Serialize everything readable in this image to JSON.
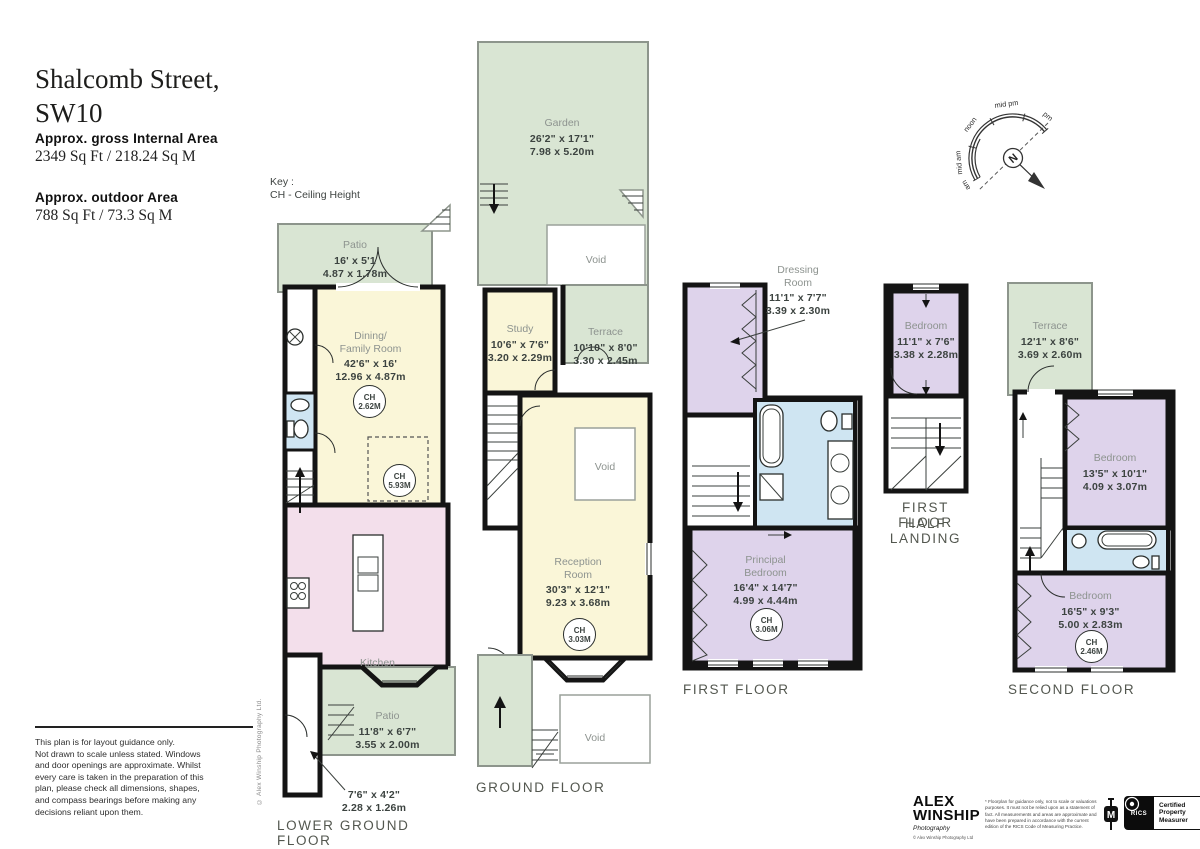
{
  "header": {
    "title": "Shalcomb Street,\nSW10",
    "internal_label": "Approx. gross Internal Area",
    "internal_value": "2349 Sq Ft  /  218.24 Sq M",
    "outdoor_label": "Approx. outdoor Area",
    "outdoor_value": "788 Sq Ft  /  73.3 Sq M"
  },
  "key": {
    "line1": "Key :",
    "line2": "CH - Ceiling Height"
  },
  "compass": {
    "labels": [
      "am",
      "mid am",
      "noon",
      "mid pm",
      "pm"
    ],
    "north": "N"
  },
  "floors": {
    "lgf": {
      "label": "LOWER GROUND FLOOR"
    },
    "gf": {
      "label": "GROUND FLOOR"
    },
    "ff": {
      "label": "FIRST FLOOR"
    },
    "hl": {
      "label_line1": "FIRST FLOOR",
      "label_line2": "HALF LANDING"
    },
    "sf": {
      "label": "SECOND FLOOR"
    }
  },
  "rooms": {
    "void": "Void",
    "lgf_patio_top": {
      "name": "Patio",
      "ft": "16' x 5'1",
      "m": "4.87 x 1.78m"
    },
    "lgf_dining": {
      "name": "Dining/\nFamily Room",
      "ft": "42'6\" x 16'",
      "m": "12.96 x 4.87m",
      "ch1_label": "CH",
      "ch1_value": "2.62M",
      "ch2_label": "CH",
      "ch2_value": "5.93M"
    },
    "lgf_kitchen": {
      "name": "Kitchen"
    },
    "lgf_patio_bottom": {
      "name": "Patio",
      "ft": "11'8\" x 6'7\"",
      "m": "3.55 x 2.00m"
    },
    "lgf_store_callout": {
      "ft": "7'6\" x 4'2\"",
      "m": "2.28 x 1.26m"
    },
    "gf_garden": {
      "name": "Garden",
      "ft": "26'2\" x 17'1\"",
      "m": "7.98 x 5.20m"
    },
    "gf_study": {
      "name": "Study",
      "ft": "10'6\" x 7'6\"",
      "m": "3.20 x 2.29m"
    },
    "gf_terrace": {
      "name": "Terrace",
      "ft": "10'10\" x 8'0\"",
      "m": "3.30 x 2.45m"
    },
    "gf_reception": {
      "name": "Reception\nRoom",
      "ft": "30'3\" x 12'1\"",
      "m": "9.23 x 3.68m",
      "ch_label": "CH",
      "ch_value": "3.03M"
    },
    "ff_dressing": {
      "name": "Dressing\nRoom",
      "ft": "11'1\" x 7'7\"",
      "m": "3.39 x 2.30m"
    },
    "ff_principal": {
      "name": "Principal\nBedroom",
      "ft": "16'4\" x 14'7\"",
      "m": "4.99 x 4.44m",
      "ch_label": "CH",
      "ch_value": "3.06M"
    },
    "hl_bedroom": {
      "name": "Bedroom",
      "ft": "11'1\" x 7'6\"",
      "m": "3.38 x 2.28m"
    },
    "sf_terrace": {
      "name": "Terrace",
      "ft": "12'1\" x 8'6\"",
      "m": "3.69 x 2.60m"
    },
    "sf_bedroom_top": {
      "name": "Bedroom",
      "ft": "13'5\" x 10'1\"",
      "m": "4.09 x 3.07m"
    },
    "sf_bedroom_bottom": {
      "name": "Bedroom",
      "ft": "16'5\" x 9'3\"",
      "m": "5.00 x 2.83m",
      "ch_label": "CH",
      "ch_value": "2.46M"
    }
  },
  "footer": {
    "disclaimer": "This plan is for layout guidance only.\nNot drawn to scale unless stated. Windows\nand door openings are approximate. Whilst\nevery care is taken in the preparation of this\nplan, please check all dimensions, shapes,\nand compass bearings before making any\ndecisions reliant upon them.",
    "copyright_vertical": "© Alex Winship Photography Ltd.",
    "logo_line1": "ALEX",
    "logo_line2": "WINSHIP",
    "logo_sub": "Photography",
    "logo_tiny": "© Alex Winship Photography Ltd",
    "fine_print": "* Floorplan for guidance only, not to scale or valuations purposes. It must not be relied upon as a statement of fact. All measurements and areas are approximate and have been prepared in accordance with the current edition of the RICS Code of Measuring Practice.",
    "tape_label": "M",
    "rics_name": "RICS",
    "rics_cert": "Certified\nProperty\nMeasurer"
  },
  "colors": {
    "outdoor_green": "#d9e5d3",
    "living_yellow": "#faf6d8",
    "kitchen_pink": "#f3dfeb",
    "bedroom_purple": "#ded3eb",
    "bathroom_blue": "#cfe5f2",
    "wall_black": "#141414"
  }
}
